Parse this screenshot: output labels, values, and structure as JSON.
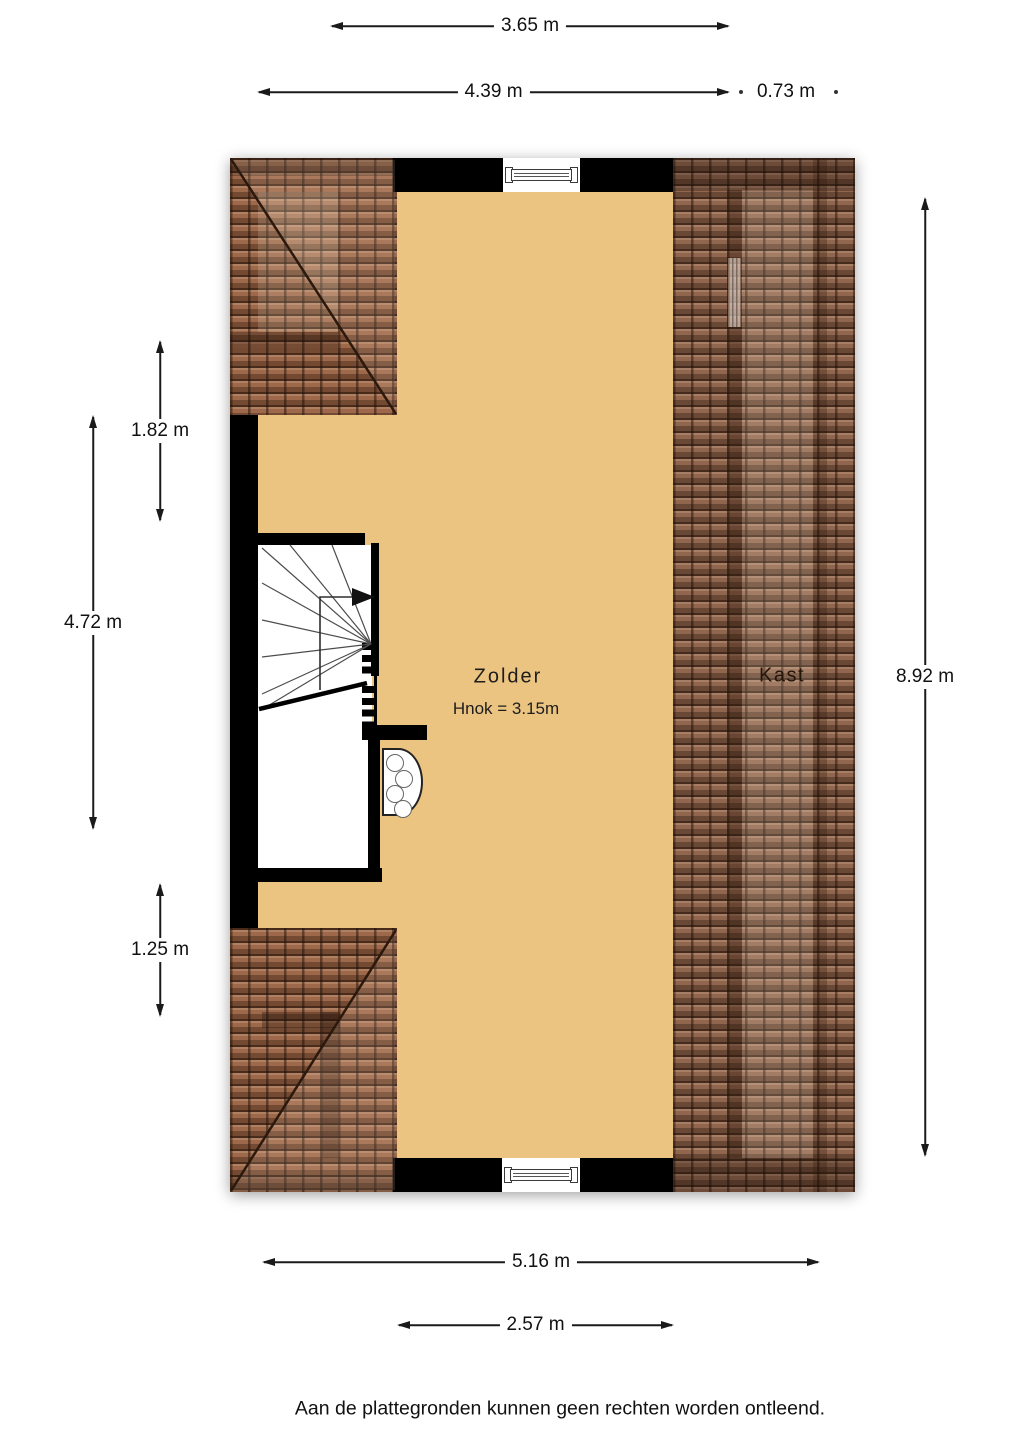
{
  "plan": {
    "rooms": {
      "zolder": {
        "label": "Zolder",
        "height_note": "Hnok = 3.15m"
      },
      "kast": {
        "label": "Kast"
      }
    },
    "colors": {
      "floor": "#ecc481",
      "roof_tiles": "#8d6048",
      "wall": "#000000"
    }
  },
  "dimensions": {
    "top_inner_width": "3.65 m",
    "top_left_width": "4.39 m",
    "top_right_width": "0.73 m",
    "left_upper": "1.82 m",
    "left_middle": "4.72 m",
    "left_lower": "1.25 m",
    "right_full_height": "8.92 m",
    "bottom_full_width": "5.16 m",
    "bottom_inner_width": "2.57 m"
  },
  "footer": {
    "disclaimer": "Aan de plattegronden kunnen geen rechten worden ontleend."
  }
}
